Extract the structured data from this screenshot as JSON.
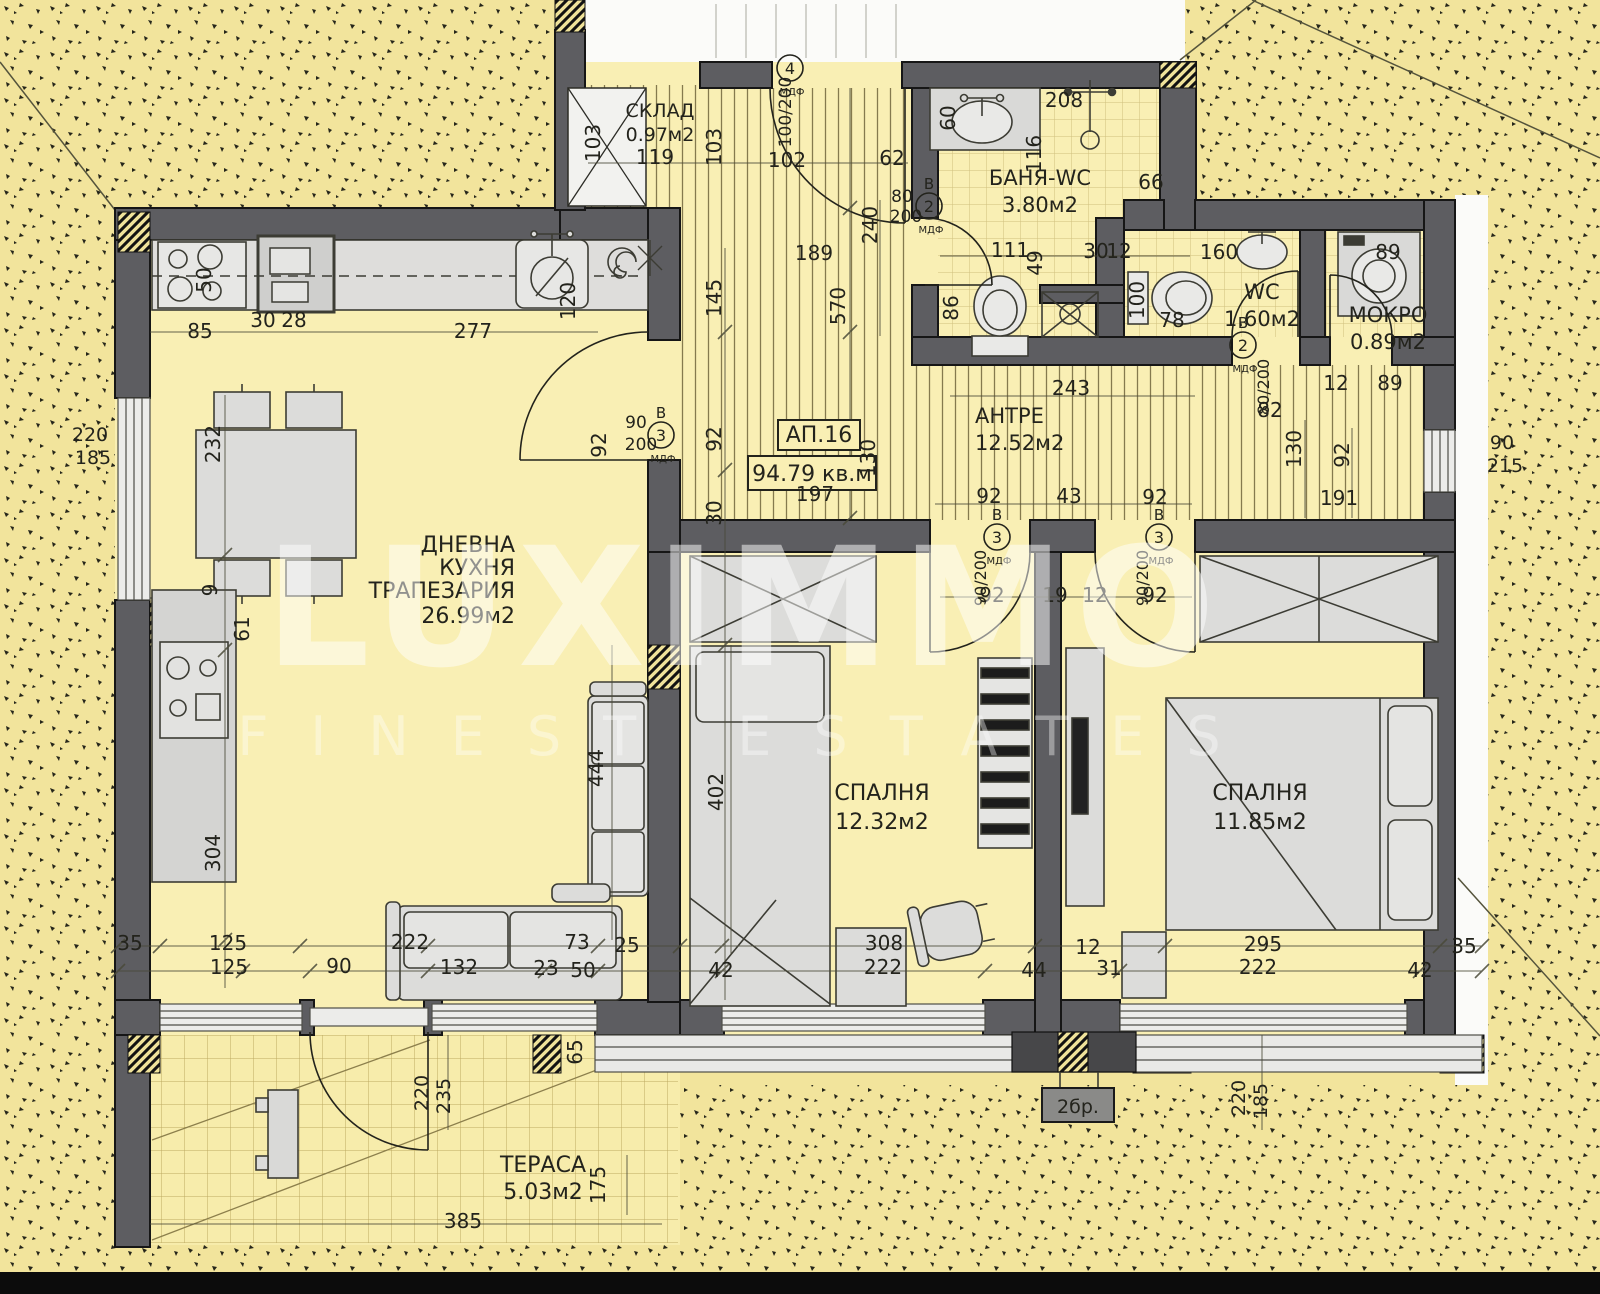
{
  "title": "Apartment floor plan",
  "watermark": {
    "brand": "LUXIMMO",
    "tagline": "FINEST ESTATES"
  },
  "apartment": {
    "number": "АП.16",
    "total_area": "94.79 кв.м"
  },
  "colors": {
    "wall": "#5d5d61",
    "floor": "#f9efb4",
    "outdoor": "#f2e49c",
    "furniture": "#dcdcda",
    "text": "#23231c",
    "bottom_bar": "#0c0c0c"
  },
  "rooms": [
    {
      "lines": [
        "СКЛАД"
      ],
      "area": "0.97м2",
      "x": 660,
      "y": 117,
      "size": 19,
      "lh": 22
    },
    {
      "lines": [
        "БАНЯ-WC"
      ],
      "area": "3.80м2",
      "x": 1040,
      "y": 185,
      "size": 21,
      "lh": 25
    },
    {
      "lines": [
        "WC"
      ],
      "area": "1.60м2",
      "x": 1262,
      "y": 299,
      "size": 21,
      "lh": 25
    },
    {
      "lines": [
        "МОКРО"
      ],
      "area": "0.89м2",
      "x": 1388,
      "y": 322,
      "size": 21,
      "lh": 25
    },
    {
      "lines": [
        "АНТРЕ"
      ],
      "area": "12.52м2",
      "x": 975,
      "y": 423,
      "size": 21,
      "lh": 25,
      "anchor": "start"
    },
    {
      "lines": [
        "ДНЕВНА",
        "КУХНЯ",
        "ТРАПЕЗАРИЯ"
      ],
      "area": "26.99м2",
      "x": 515,
      "y": 552,
      "size": 22,
      "lh": 23,
      "anchor": "end"
    },
    {
      "lines": [
        "СПАЛНЯ"
      ],
      "area": "12.32м2",
      "x": 882,
      "y": 800,
      "size": 22,
      "lh": 27
    },
    {
      "lines": [
        "СПАЛНЯ"
      ],
      "area": "11.85м2",
      "x": 1260,
      "y": 800,
      "size": 22,
      "lh": 27
    },
    {
      "lines": [
        "ТЕРАСА"
      ],
      "area": "5.03м2",
      "x": 543,
      "y": 1172,
      "size": 22,
      "lh": 25
    }
  ],
  "extra_labels": [
    {
      "t": "2бр.",
      "x": 1078,
      "y": 1113,
      "size": 19
    }
  ],
  "door_tags": [
    {
      "letter": "",
      "num": "4",
      "x": 790,
      "y": 68,
      "mdf": "МДФ"
    },
    {
      "letter": "В",
      "num": "2",
      "x": 929,
      "y": 206,
      "mdf": "МДФ"
    },
    {
      "letter": "В",
      "num": "3",
      "x": 661,
      "y": 435,
      "mdf": "МДФ"
    },
    {
      "letter": "В",
      "num": "3",
      "x": 997,
      "y": 537,
      "mdf": "МДФ"
    },
    {
      "letter": "В",
      "num": "3",
      "x": 1159,
      "y": 537,
      "mdf": "МДФ"
    },
    {
      "letter": "В",
      "num": "2",
      "x": 1243,
      "y": 345,
      "mdf": "МДФ"
    }
  ],
  "dimensions": [
    [
      "85",
      200,
      338
    ],
    [
      "30",
      263,
      327
    ],
    [
      "28",
      294,
      327
    ],
    [
      "277",
      473,
      338
    ],
    [
      "50",
      211,
      280,
      "v"
    ],
    [
      "120",
      575,
      301,
      "v"
    ],
    [
      "103",
      600,
      143,
      "v"
    ],
    [
      "119",
      655,
      164
    ],
    [
      "103",
      721,
      147,
      "v"
    ],
    [
      "102",
      787,
      167
    ],
    [
      "62",
      892,
      165
    ],
    [
      "100/200",
      791,
      112,
      "v",
      17
    ],
    [
      "189",
      814,
      260
    ],
    [
      "145",
      721,
      298,
      "v"
    ],
    [
      "570",
      845,
      306,
      "v"
    ],
    [
      "240",
      877,
      225,
      "v"
    ],
    [
      "80",
      902,
      202,
      0,
      17
    ],
    [
      "200",
      906,
      222,
      0,
      17
    ],
    [
      "60",
      955,
      118,
      "v"
    ],
    [
      "208",
      1064,
      107
    ],
    [
      "116",
      1041,
      154,
      "v"
    ],
    [
      "66",
      1151,
      189
    ],
    [
      "111",
      1010,
      257
    ],
    [
      "49",
      1042,
      263,
      "v"
    ],
    [
      "86",
      958,
      308,
      "v"
    ],
    [
      "30",
      1096,
      258
    ],
    [
      "12",
      1119,
      258
    ],
    [
      "100",
      1144,
      300,
      "v"
    ],
    [
      "78",
      1172,
      327
    ],
    [
      "160",
      1219,
      259
    ],
    [
      "89",
      1388,
      259
    ],
    [
      "82",
      1270,
      417
    ],
    [
      "12",
      1336,
      390
    ],
    [
      "89",
      1390,
      390
    ],
    [
      "243",
      1071,
      395
    ],
    [
      "92",
      606,
      445,
      "v"
    ],
    [
      "90",
      636,
      428,
      0,
      17
    ],
    [
      "200",
      641,
      450,
      0,
      17
    ],
    [
      "92",
      721,
      439,
      "v"
    ],
    [
      "30",
      721,
      513,
      "v"
    ],
    [
      "130",
      875,
      458,
      "v"
    ],
    [
      "197",
      815,
      501
    ],
    [
      "92",
      989,
      503
    ],
    [
      "43",
      1069,
      503
    ],
    [
      "92",
      1155,
      504
    ],
    [
      "92",
      992,
      602
    ],
    [
      "19",
      1055,
      602
    ],
    [
      "12",
      1095,
      602
    ],
    [
      "92",
      1155,
      602
    ],
    [
      "90/200",
      986,
      578,
      "v",
      16
    ],
    [
      "90/200",
      1148,
      578,
      "v",
      16
    ],
    [
      "80/200",
      1269,
      387,
      "v",
      16
    ],
    [
      "130",
      1301,
      449,
      "v"
    ],
    [
      "92",
      1349,
      455,
      "v"
    ],
    [
      "191",
      1339,
      505
    ],
    [
      "90",
      1502,
      449,
      0,
      19
    ],
    [
      "215",
      1505,
      472,
      0,
      19
    ],
    [
      "220",
      90,
      441,
      0,
      19
    ],
    [
      "185",
      93,
      464,
      0,
      19
    ],
    [
      "232",
      220,
      444,
      "v"
    ],
    [
      "9",
      217,
      590,
      "v"
    ],
    [
      "61",
      249,
      629,
      "v"
    ],
    [
      "304",
      220,
      853,
      "v"
    ],
    [
      "444",
      603,
      768,
      "v"
    ],
    [
      "402",
      723,
      792,
      "v"
    ],
    [
      "35",
      130,
      950
    ],
    [
      "125",
      228,
      950
    ],
    [
      "125",
      229,
      974
    ],
    [
      "90",
      339,
      973
    ],
    [
      "222",
      410,
      949
    ],
    [
      "132",
      459,
      974
    ],
    [
      "73",
      577,
      949
    ],
    [
      "23",
      546,
      975
    ],
    [
      "50",
      583,
      977
    ],
    [
      "25",
      627,
      952
    ],
    [
      "65",
      582,
      1052,
      "v"
    ],
    [
      "42",
      721,
      977
    ],
    [
      "308",
      884,
      950
    ],
    [
      "222",
      883,
      974
    ],
    [
      "44",
      1034,
      977
    ],
    [
      "12",
      1088,
      954
    ],
    [
      "31",
      1109,
      975
    ],
    [
      "295",
      1263,
      951
    ],
    [
      "222",
      1258,
      974
    ],
    [
      "42",
      1420,
      977
    ],
    [
      "35",
      1464,
      953
    ],
    [
      "220",
      428,
      1093,
      "v",
      19
    ],
    [
      "235",
      450,
      1096,
      "v",
      19
    ],
    [
      "385",
      463,
      1228
    ],
    [
      "175",
      605,
      1185,
      "v"
    ],
    [
      "220",
      1245,
      1098,
      "v",
      19
    ],
    [
      "185",
      1267,
      1101,
      "v",
      19
    ]
  ]
}
